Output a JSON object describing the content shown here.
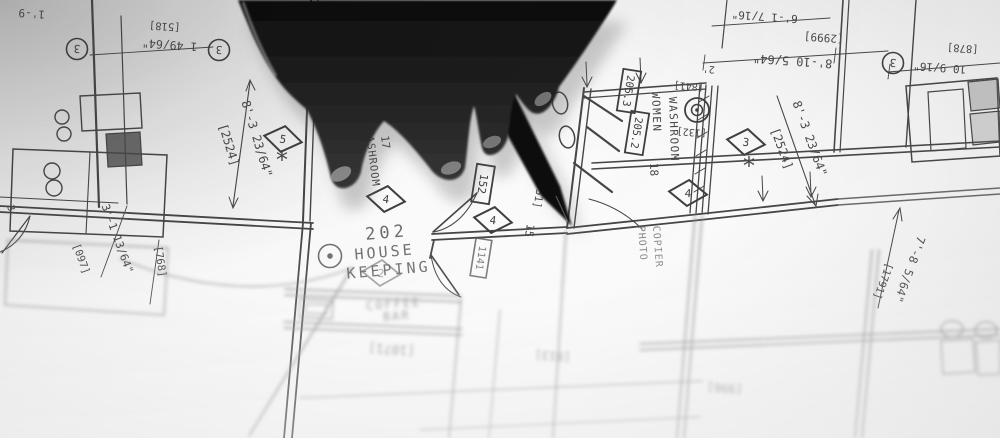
{
  "blueprint": {
    "rooms": {
      "housekeeping": {
        "number": "202",
        "line1": "HOUSE",
        "line2": "KEEPING"
      },
      "men_washroom": {
        "name": "MEN WASHROOM",
        "number": "17"
      },
      "women_washroom": {
        "line1": "WOMEN",
        "line2": "WASHROOM",
        "number": "18"
      },
      "coffee_bar": {
        "line1": "COFFEE",
        "line2": "BAR"
      },
      "photo_copier": {
        "line1": "PHOTO",
        "line2": "COPIER"
      }
    },
    "door_tags": [
      "205.3",
      "205.2",
      "152",
      "1141"
    ],
    "keynote_diamonds": [
      "5",
      "4",
      "4",
      "4",
      "3",
      "2"
    ],
    "revision_circles": [
      "3",
      "3",
      "3"
    ],
    "keynote_stars": [
      "*",
      "*"
    ],
    "dimensions": [
      {
        "text": "1'-9"
      },
      {
        "text": "1 49/64\""
      },
      {
        "text": "[518]"
      },
      {
        "text": "8'-3 23/64\""
      },
      {
        "text": "[2524]"
      },
      {
        "text": "8'-3 23/64\""
      },
      {
        "text": "[2524]"
      },
      {
        "text": "6'-1 7/16\""
      },
      {
        "text": "[2999]"
      },
      {
        "text": "8'-10 5/64\""
      },
      {
        "text": "10 9/16\""
      },
      {
        "text": "[878]"
      },
      {
        "text": "2'"
      },
      {
        "text": "[841]"
      },
      {
        "text": "[132]"
      },
      {
        "text": "3'-1 13/64\""
      },
      {
        "text": "[097]"
      },
      {
        "text": "[768]"
      },
      {
        "text": "3'"
      },
      {
        "text": "[951]"
      },
      {
        "text": "15"
      },
      {
        "text": "7'-8 5/64\""
      },
      {
        "text": "[1791]"
      },
      {
        "text": "[1071]"
      },
      {
        "text": "[813]"
      },
      {
        "text": "[996]"
      }
    ]
  }
}
